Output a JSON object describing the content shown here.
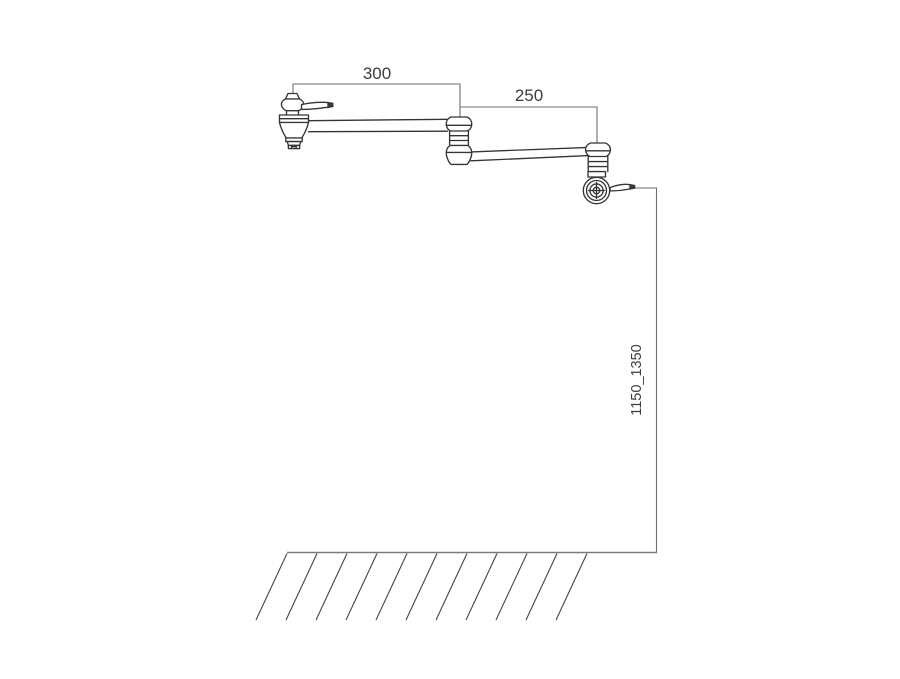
{
  "drawing": {
    "type": "technical-drawing",
    "subject": "wall-mounted double-jointed pot filler faucet, side elevation with installation dimensions",
    "background_color": "#ffffff",
    "outline_color": "#343434",
    "dimension_line_color": "#6e6e6e",
    "text_color": "#3d3d3d",
    "units": "mm"
  },
  "dimensions": {
    "arm1": {
      "label": "300",
      "orientation": "horizontal",
      "measures": "first swing arm reach"
    },
    "arm2": {
      "label": "250",
      "orientation": "horizontal",
      "measures": "second swing arm reach"
    },
    "height": {
      "label": "1150_1350",
      "orientation": "vertical",
      "measures": "mounting height above floor"
    }
  },
  "parts": {
    "wall_valve": "wall-mount valve body with lever handle",
    "joint": "double-knuckle swivel joint",
    "spout": "swivel spout end with lever handle",
    "floor": "hatched floor/ground line"
  }
}
